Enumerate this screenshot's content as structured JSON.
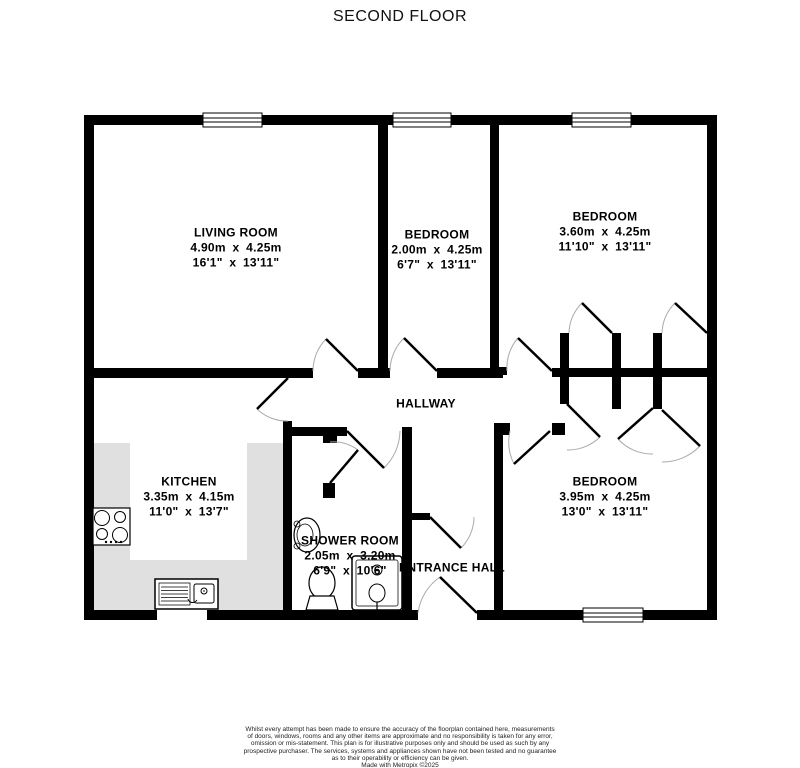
{
  "title": "SECOND FLOOR",
  "colors": {
    "wall": "#000000",
    "counter": "#e0e0e0",
    "background": "#ffffff",
    "door_arc": "#aaaaaa"
  },
  "rooms": [
    {
      "id": "living-room",
      "name": "LIVING ROOM",
      "metric": "4.90m x 4.25m",
      "imperial": "16'1\" x 13'11\""
    },
    {
      "id": "bedroom-middle",
      "name": "BEDROOM",
      "metric": "2.00m x 4.25m",
      "imperial": "6'7\" x 13'11\""
    },
    {
      "id": "bedroom-top-right",
      "name": "BEDROOM",
      "metric": "3.60m x 4.25m",
      "imperial": "11'10\" x 13'11\""
    },
    {
      "id": "hallway",
      "name": "HALLWAY"
    },
    {
      "id": "kitchen",
      "name": "KITCHEN",
      "metric": "3.35m x 4.15m",
      "imperial": "11'0\" x 13'7\""
    },
    {
      "id": "shower-room",
      "name": "SHOWER ROOM",
      "metric": "2.05m x 3.20m",
      "imperial": "6'9\" x 10'6\""
    },
    {
      "id": "entrance-hall",
      "name": "ENTRANCE HALL"
    },
    {
      "id": "bedroom-bottom-right",
      "name": "BEDROOM",
      "metric": "3.95m x 4.25m",
      "imperial": "13'0\" x 13'11\""
    }
  ],
  "fixtures": [
    "hob",
    "kitchen-sink",
    "wash-basin",
    "toilet",
    "shower"
  ],
  "footer": {
    "disclaimer": "Whilst every attempt has been made to ensure the accuracy of the floorplan contained here, measurements\nof doors, windows, rooms and any other items are approximate and no responsibility is taken for any error,\nomission or mis-statement. This plan is for illustrative purposes only and should be used as such by any\nprospective purchaser. The services, systems and appliances shown have not been tested and no guarantee\nas to their operability or efficiency can be given.",
    "credit": "Made with Metropix ©2025"
  }
}
